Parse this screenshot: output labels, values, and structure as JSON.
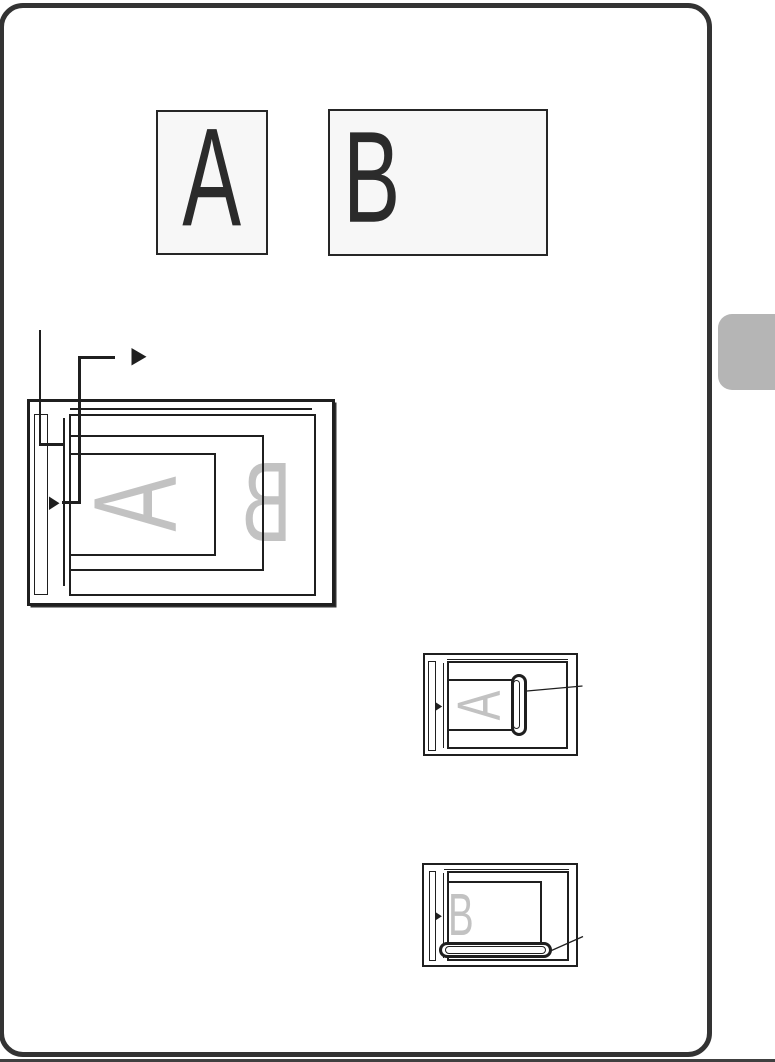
{
  "palette": {
    "background": "#ffffff",
    "line_color": "#1f1f1f",
    "ghost_letter_color": "#c2c2c2",
    "card_border_color": "#333333",
    "sample_box_fill": "#f7f7f7",
    "side_tab_fill": "#b5b5b5",
    "bottom_edge_color": "#404040"
  },
  "sample_documents": {
    "a_label": "A",
    "b_label": "B"
  },
  "main_platen_diagram": {
    "ghost_a": "A",
    "ghost_b": "B"
  },
  "detail_diagram_a": {
    "ghost": "A"
  },
  "detail_diagram_b": {
    "ghost": "B"
  },
  "icons": {
    "alignment_mark": "right-pointing solid triangle"
  }
}
